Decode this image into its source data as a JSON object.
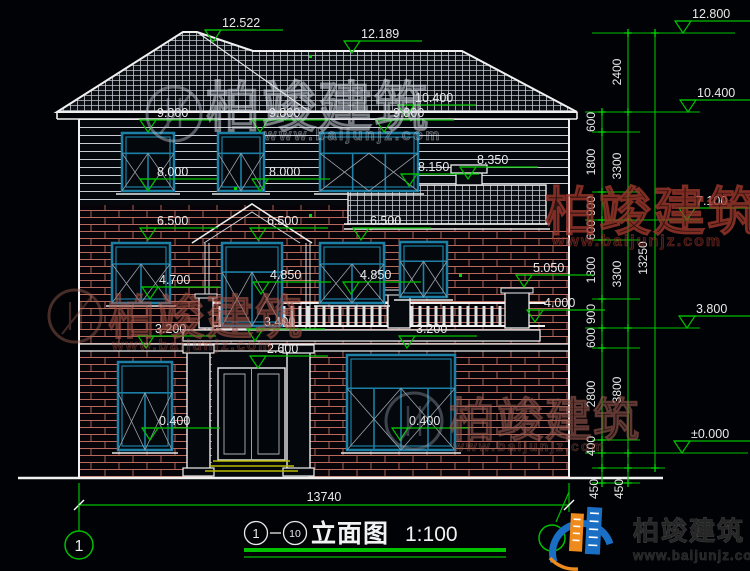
{
  "title_block": {
    "bubble_start": "1",
    "bubble_end": "10",
    "drawing_name": "立面图",
    "scale": "1:100"
  },
  "grid_bubbles": {
    "left": "1"
  },
  "dimensions": {
    "overall_width": "13740",
    "d2400": "2400",
    "d600": "600",
    "d1800": "1800",
    "d900": "900",
    "d3300": "3300",
    "d2800": "2800",
    "d400": "400",
    "d450": "450",
    "d3800": "3800",
    "d13250": "13250"
  },
  "elevations": {
    "e12_800": "12.800",
    "e12_522": "12.522",
    "e12_189": "12.189",
    "e10_400": "10.400",
    "e9_800": "9.800",
    "e8_350": "8.350",
    "e8_150": "8.150",
    "e8_000": "8.000",
    "e7_100": "7.100",
    "e6_500": "6.500",
    "e5_050": "5.050",
    "e4_850": "4.850",
    "e4_700": "4.700",
    "e4_000": "4.000",
    "e3_800": "3.800",
    "e3_400": "3.400",
    "e3_200": "3.200",
    "e2_600": "2.600",
    "e0_400": "0.400",
    "e0_000": "±0.000"
  },
  "watermark": {
    "brand": "柏竣建筑",
    "url": "www.baijunjz.com"
  },
  "logo": {
    "brand": "柏竣建筑",
    "url": "www.baijunjz.com"
  },
  "colors": {
    "background": "#000205",
    "line_white": "#f0f0f0",
    "dim_green": "#00c000",
    "window_teal": "#1b7fa6",
    "brick_red": "#b96a5c",
    "logo_blue": "#1a6fc4",
    "logo_orange": "#ef8a1c"
  }
}
